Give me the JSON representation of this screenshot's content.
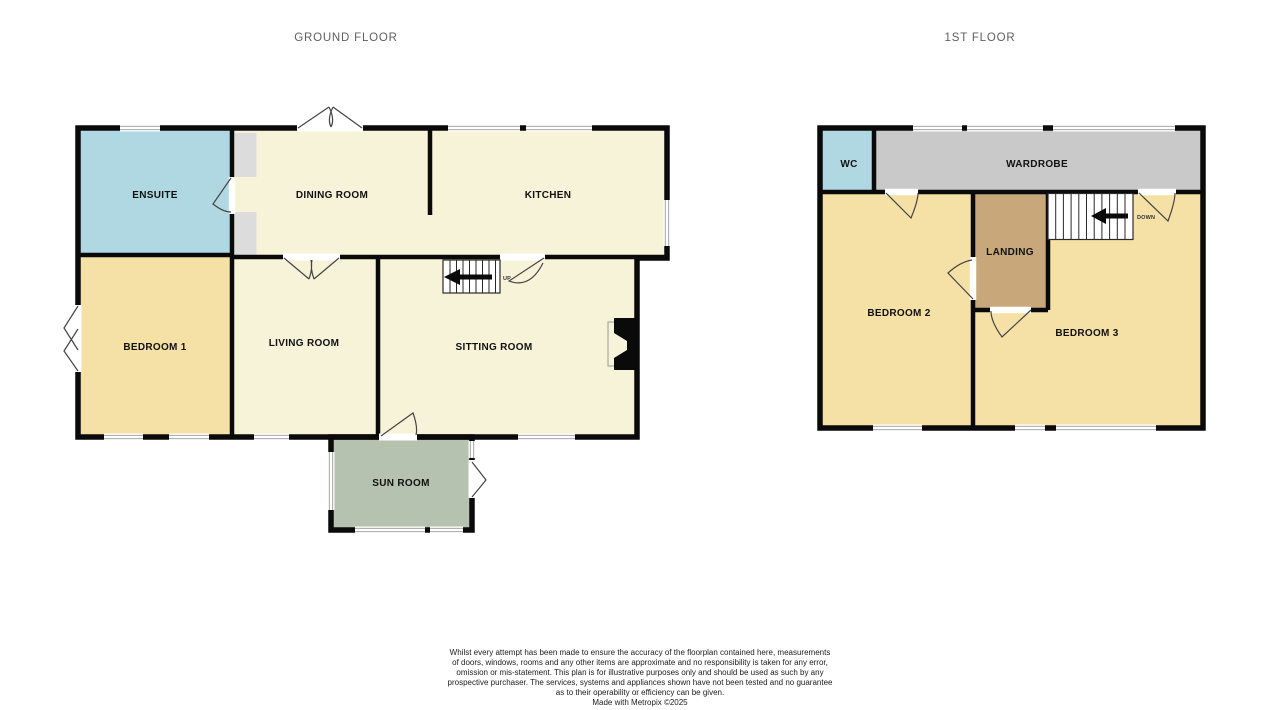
{
  "palette": {
    "wall": "#0a0a0a",
    "cream": "#f7f3d9",
    "yellow": "#f5e1a6",
    "blue": "#b0d8e2",
    "sage": "#b6c2b0",
    "wardrobe_gray": "#c9c9c9",
    "landing_tan": "#c8a87b",
    "alcove_gray": "#dcdcdc"
  },
  "ground_floor": {
    "title": "GROUND FLOOR",
    "rooms": {
      "ensuite": "ENSUITE",
      "dining": "DINING ROOM",
      "kitchen": "KITCHEN",
      "bedroom1": "BEDROOM 1",
      "living": "LIVING ROOM",
      "sitting": "SITTING ROOM",
      "sunroom": "SUN ROOM"
    },
    "stairs_label": "UP"
  },
  "first_floor": {
    "title": "1ST FLOOR",
    "rooms": {
      "wc": "WC",
      "wardrobe": "WARDROBE",
      "landing": "LANDING",
      "bedroom2": "BEDROOM 2",
      "bedroom3": "BEDROOM 3"
    },
    "stairs_label": "DOWN"
  },
  "footer": {
    "disclaimer_lines": [
      "Whilst every attempt has been made to ensure the accuracy of the floorplan contained here, measurements",
      "of doors, windows, rooms and any other items are approximate and no responsibility is taken for any error,",
      "omission or mis-statement. This plan is for illustrative purposes only and should be used as such by any",
      "prospective purchaser. The services, systems and appliances shown have not been tested and no guarantee",
      "as to their operability or efficiency can be given."
    ],
    "credit": "Made with Metropix ©2025"
  }
}
